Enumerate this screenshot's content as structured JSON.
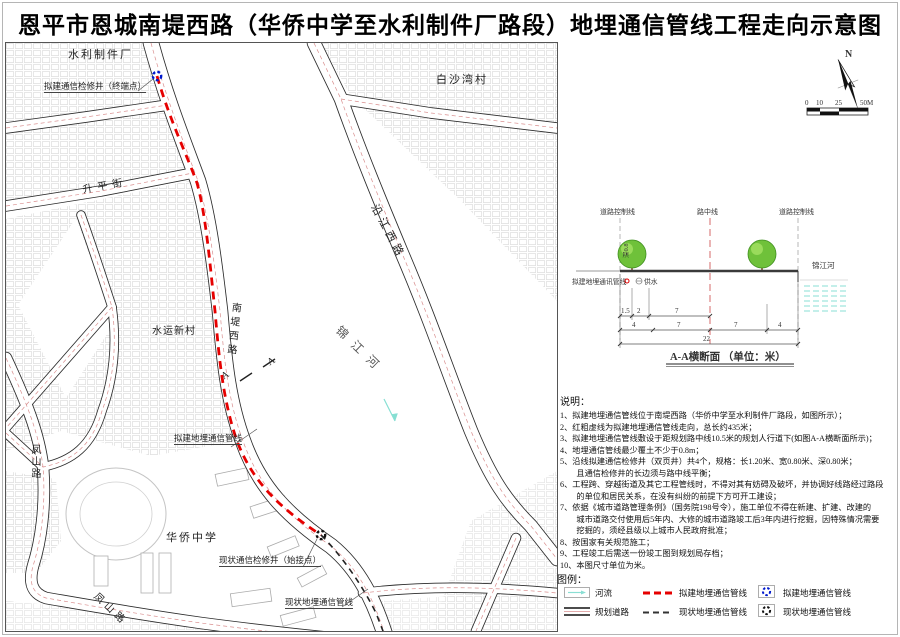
{
  "title": "恩平市恩城南堤西路（华侨中学至水利制件厂路段）地埋通信管线工程走向示意图",
  "compass": {
    "north": "N"
  },
  "scalebar": {
    "t0": "0",
    "t1": "10",
    "t2": "25",
    "t3": "50M"
  },
  "map": {
    "labels": {
      "factory": "水利制件厂",
      "terminal_well": "拟建通信检修井（终端点）",
      "baisha_village": "白沙湾村",
      "shengping_street": "升平街",
      "yanjiang_road": "沿江西路",
      "shuiyun_village": "水运新村",
      "nandi_road": "南堤西路",
      "jinjiang_river": "锦江河",
      "school": "华侨中学",
      "proposed_line": "拟建地埋通信管线",
      "start_well": "现状通信检修井（始接点）",
      "existing_line": "现状地埋通信管线",
      "fengshan_road": "凤山路",
      "section_mark": "A"
    },
    "colors": {
      "proposed_line": "#e60000",
      "existing_line": "#222222",
      "proposed_well": "#0018cc",
      "existing_well": "#111111",
      "river_flow": "#86dfd3",
      "road_centerline": "#d98f8f"
    }
  },
  "section": {
    "caption": "A-A横断面 （单位：米）",
    "control_line_left": "道路控制线",
    "center_line": "路中线",
    "control_line_right": "道路控制线",
    "river": "锦江河",
    "pipe": "拟建地埋通讯管线",
    "water": "供水",
    "depth": "深0.8",
    "row1": [
      "1.5",
      "2",
      "7"
    ],
    "row2": [
      "4",
      "7",
      "7",
      "4"
    ],
    "total": "22"
  },
  "notes": {
    "heading": "说明：",
    "lines": [
      "1、拟建地埋通信管线位于南堤西路（华侨中学至水利制件厂路段，如图所示）；",
      "2、红粗虚线为拟建地埋通信管线走向，总长约435米；",
      "3、拟建地埋通信管线敷设于距规划路中线10.5米的规划人行道下(如图A-A横断面所示)；",
      "4、地埋通信管线最少覆土不少于0.8m；",
      "5、沿线拟建通信检修井（双页井）共4个，规格：长1.20米、宽0.80米、深0.80米；",
      "　　且通信检修井的长边须与路中线平衡；",
      "6、工程跨、穿越街道及其它工程管线时，不得对其有妨碍及破坏，并协调好线路经过路段",
      "　　的单位和居民关系，在没有纠纷的前提下方可开工建设；",
      "7、依据《城市道路管理条例》（国务院198号令），施工单位不得在新建、扩建、改建的",
      "　　城市道路交付使用后5年内、大修的城市道路竣工后3年内进行挖掘，因特殊情况需要",
      "　　挖掘的，须经县级以上城市人民政府批准；",
      "8、按国家有关规范施工；",
      "9、工程竣工后需送一份竣工图到规划局存档；",
      "10、本图尺寸单位为米。"
    ]
  },
  "legend": {
    "heading": "图例：",
    "items": [
      {
        "symbol": "river",
        "label": "河流"
      },
      {
        "symbol": "proposed-line",
        "label": "拟建地埋通信管线"
      },
      {
        "symbol": "proposed-well",
        "label": "拟建地埋通信管线"
      },
      {
        "symbol": "planned-road",
        "label": "规划道路"
      },
      {
        "symbol": "existing-line",
        "label": "现状地埋通信管线"
      },
      {
        "symbol": "existing-well",
        "label": "现状地埋通信管线"
      }
    ]
  }
}
